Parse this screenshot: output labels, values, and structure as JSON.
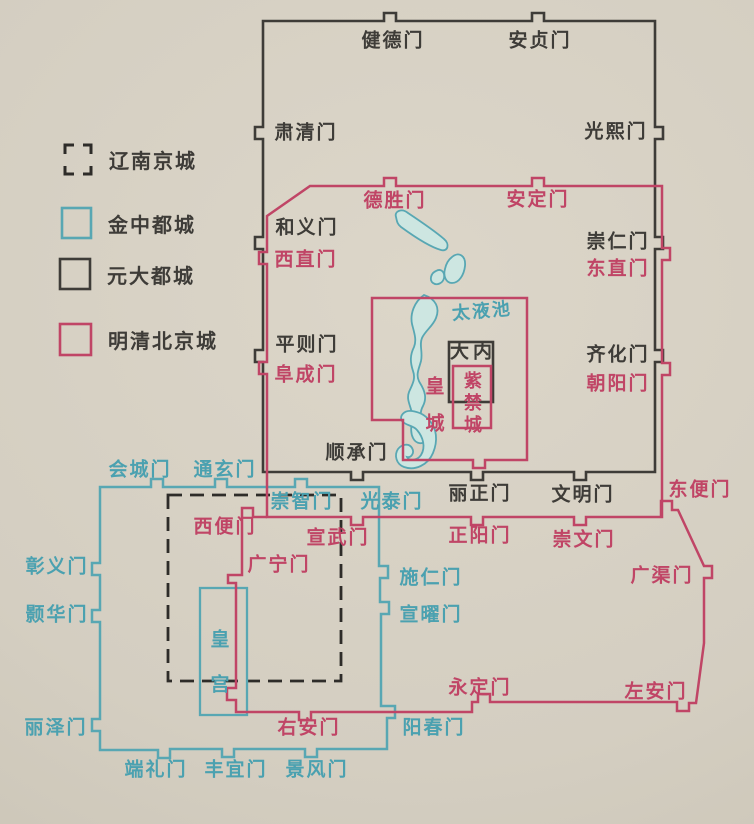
{
  "legend": {
    "items": [
      {
        "key": "liao",
        "label": "辽南京城"
      },
      {
        "key": "jin",
        "label": "金中都城"
      },
      {
        "key": "yuan",
        "label": "元大都城"
      },
      {
        "key": "ming",
        "label": "明清北京城"
      }
    ]
  },
  "colors": {
    "paper": "#d4cec1",
    "yuan_wall": "#3e3c38",
    "ming_wall": "#c04566",
    "jin_wall": "#58a7b3",
    "liao_wall": "#2e2c29",
    "lake_fill": "#cde6e1",
    "lake_stroke": "#58a7b3"
  },
  "gates": {
    "jiande": "健德门",
    "anzhen": "安贞门",
    "suqing": "肃清门",
    "guangxi": "光熙门",
    "heyi": "和义门",
    "xizhi": "西直门",
    "chongren": "崇仁门",
    "dongzhi": "东直门",
    "pingze": "平则门",
    "fucheng": "阜成门",
    "qihua": "齐化门",
    "chaoyang": "朝阳门",
    "shuncheng": "顺承门",
    "lizheng": "丽正门",
    "wenming": "文明门",
    "desheng": "德胜门",
    "anding": "安定门",
    "xuanwu": "宣武门",
    "zhengyang": "正阳门",
    "chongwen": "崇文门",
    "dongbian": "东便门",
    "guangqu": "广渠门",
    "zuoan": "左安门",
    "yongding": "永定门",
    "youan": "右安门",
    "xibian": "西便门",
    "guangning": "广宁门",
    "huicheng": "会城门",
    "tongxuan": "通玄门",
    "chongzhi": "崇智门",
    "guangtai": "光泰门",
    "zhangyi": "彰义门",
    "haohua": "颢华门",
    "lize": "丽泽门",
    "duanli": "端礼门",
    "fengyi": "丰宜门",
    "jingfeng": "景风门",
    "shiren": "施仁门",
    "xuanyao": "宣曜门",
    "yangchun": "阳春门"
  },
  "areas": {
    "taiyechi": "太液池",
    "danei": "大内",
    "zijincheng": "紫禁城",
    "huangcheng": "皇城",
    "huanggong": "皇宫"
  }
}
